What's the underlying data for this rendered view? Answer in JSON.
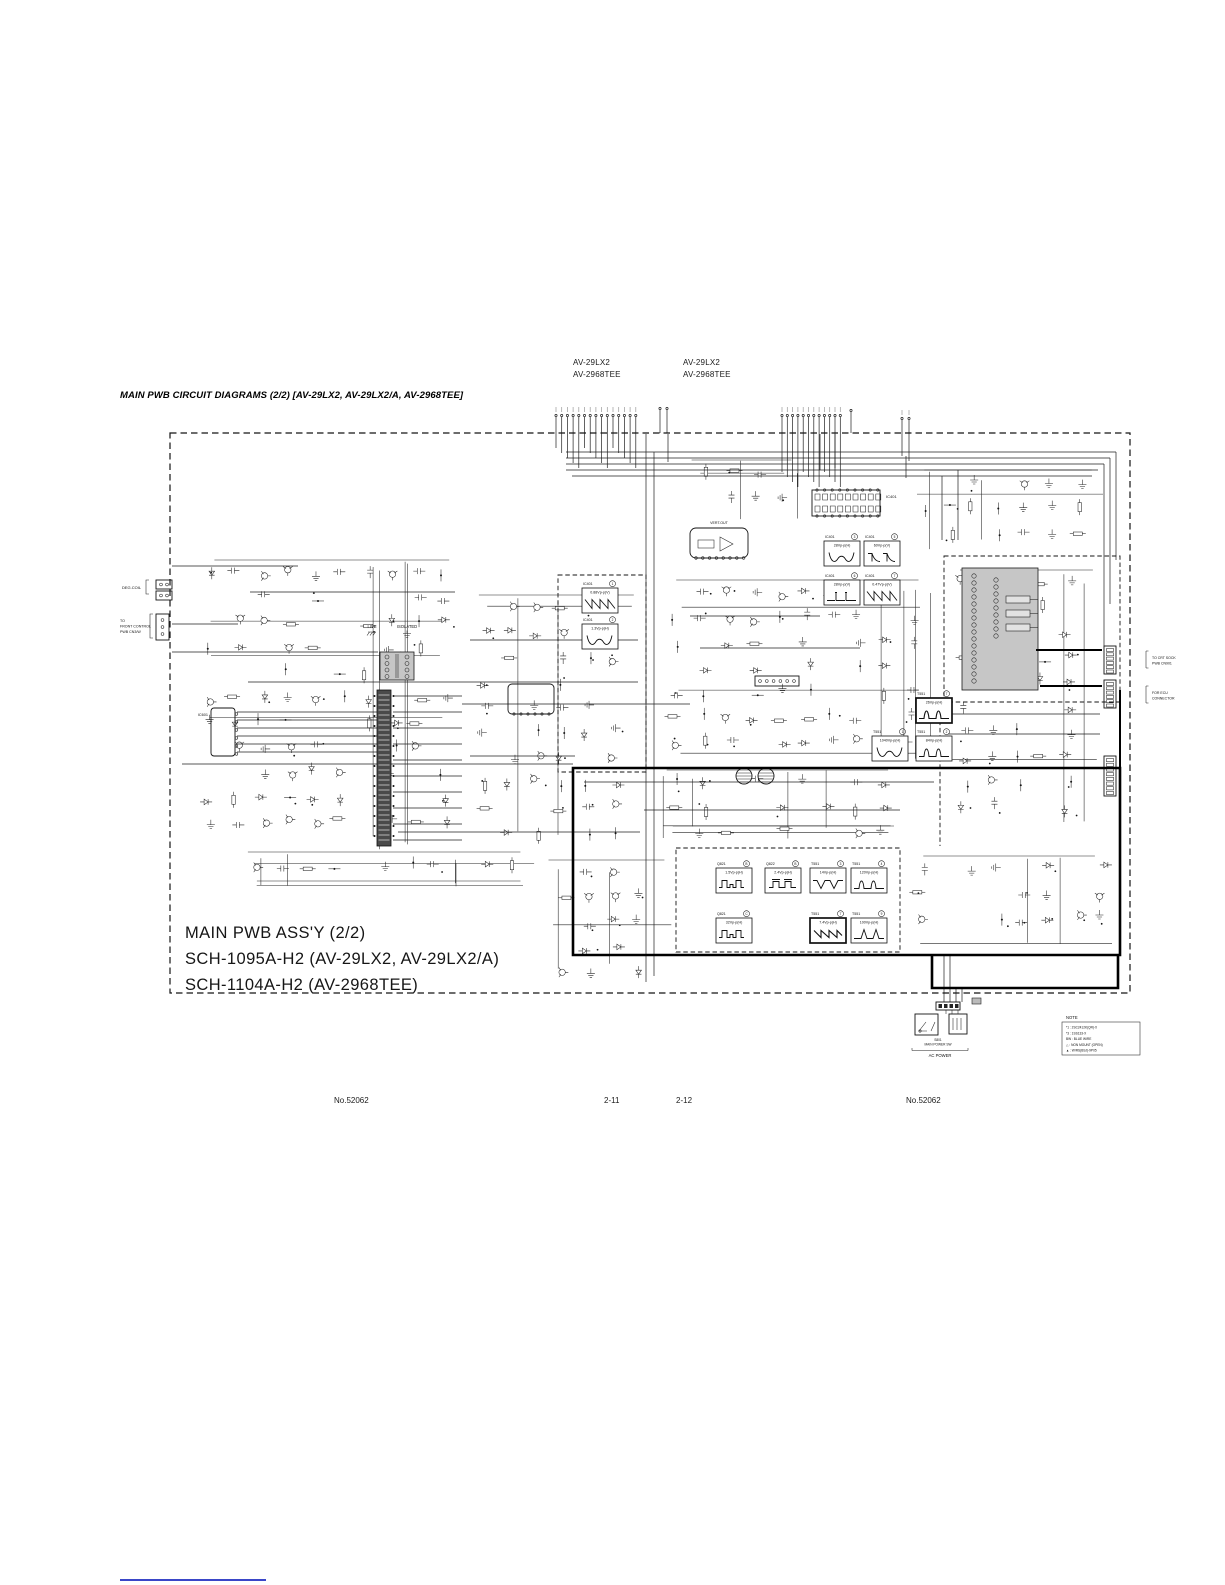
{
  "page": {
    "models_left": [
      "AV-29LX2",
      "AV-2968TEE"
    ],
    "models_right": [
      "AV-29LX2",
      "AV-2968TEE"
    ],
    "title": "MAIN PWB CIRCUIT DIAGRAMS (2/2) [AV-29LX2, AV-29LX2/A, AV-2968TEE]",
    "footer": {
      "doc_no_left": "No.52062",
      "page_left": "2-11",
      "page_right": "2-12",
      "doc_no_right": "No.52062"
    }
  },
  "schematic": {
    "assembly_title": [
      "MAIN PWB ASS'Y (2/2)",
      "SCH-1095A-H2 (AV-29LX2, AV-29LX2/A)",
      "SCH-1104A-H2 (AV-2968TEE)"
    ],
    "section_labels": {
      "live": "LIVE",
      "isolated": "ISOLATED"
    },
    "callouts": {
      "deg_coil": "DEG.COIL",
      "front_control": [
        "TO",
        "FRONT CONTROL",
        "PWB CN3/W"
      ],
      "crt_sock": [
        "TO CRT SOCK",
        "PWB CN901"
      ],
      "ecu": [
        "FOR ECU",
        "CONNECTOR"
      ],
      "ac_power": "AC POWER",
      "main_switch": [
        "S801",
        "MAIN POWER SW"
      ]
    },
    "components": {
      "ic401": "IC401",
      "ic601": "IC601",
      "vert_out": "VERT.OUT"
    },
    "waveforms": [
      {
        "ref": "IC401",
        "pin": "1",
        "value": "0.88Vp-p(V)",
        "shape": "saw"
      },
      {
        "ref": "IC401",
        "pin": "2",
        "value": "1.3Vp-p(H)",
        "shape": "w"
      },
      {
        "ref": "IC401",
        "pin": "3",
        "value": "28Vp-p(H)",
        "shape": "w"
      },
      {
        "ref": "IC401",
        "pin": "5",
        "value": "60Vp-p(V)",
        "shape": "decay"
      },
      {
        "ref": "IC401",
        "pin": "6",
        "value": "28Vp-p(V)",
        "shape": "narrow"
      },
      {
        "ref": "IC401",
        "pin": "7",
        "value": "0.47Vp-p(V)",
        "shape": "saw"
      },
      {
        "ref": "T551",
        "pin": "7",
        "value": "26Vp-p(H)",
        "shape": "pulses",
        "bold": true
      },
      {
        "ref": "T551",
        "pin": "1",
        "value": "1040Vp-p(H)",
        "shape": "w"
      },
      {
        "ref": "T551",
        "pin": "2",
        "value": "84Vp-p(H)",
        "shape": "pulses"
      },
      {
        "ref": "Q821",
        "pin": "B",
        "value": "1.5Vp-p(H)",
        "shape": "steps"
      },
      {
        "ref": "Q822",
        "pin": "B",
        "value": "2.4Vp-p(H)",
        "shape": "bars"
      },
      {
        "ref": "T551",
        "pin": "3",
        "value": "14Vp-p(H)",
        "shape": "vdips"
      },
      {
        "ref": "T551",
        "pin": "4",
        "value": "120Vp-p(H)",
        "shape": "pulses"
      },
      {
        "ref": "Q821",
        "pin": "C",
        "value": "32Vp-p(H)",
        "shape": "steps"
      },
      {
        "ref": "T551",
        "pin": "7",
        "value": "7.4Vp-p(H)",
        "shape": "sawb",
        "bold": true
      },
      {
        "ref": "T551",
        "pin": "9",
        "value": "100Vp-p(H)",
        "shape": "spikes"
      }
    ],
    "note": {
      "title": "NOTE",
      "lines": [
        "*1 : 2SC2412K(QR)-X",
        "*3 : 1SS133-X",
        "BW : BLUE WIRE",
        "△ : NON MOUNT (OPEN)",
        "▲ : W/RS(BSJ)-9P05"
      ]
    }
  }
}
